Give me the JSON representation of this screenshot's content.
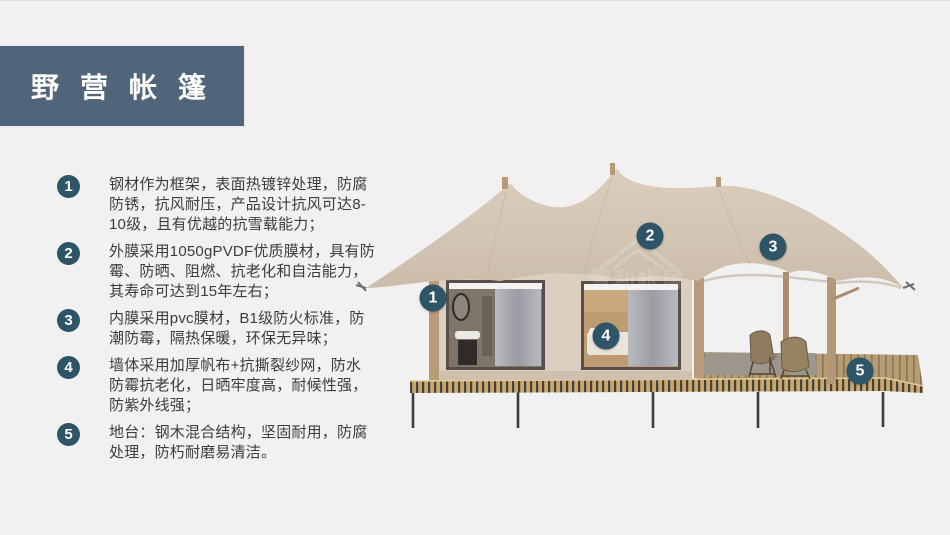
{
  "title": {
    "text": "野营帐篷"
  },
  "features": {
    "items": [
      {
        "number": "1",
        "text": "钢材作为框架，表面热镀锌处理，防腐防锈，抗风耐压，产品设计抗风可达8-10级，且有优越的抗雪载能力；"
      },
      {
        "number": "2",
        "text": "外膜采用1050gPVDF优质膜材，具有防霉、防晒、阻燃、抗老化和自洁能力，其寿命可达到15年左右；"
      },
      {
        "number": "3",
        "text": "内膜采用pvc膜材，B1级防火标准，防潮防霉，隔热保暖，环保无异味；"
      },
      {
        "number": "4",
        "text": "墙体采用加厚帆布+抗撕裂纱网，防水防霉抗老化，日晒牢度高，耐候性强，防紫外线强；"
      },
      {
        "number": "5",
        "text": "地台：钢木混合结构，坚固耐用，防腐处理，防朽耐磨易清洁。"
      }
    ]
  },
  "diagram": {
    "markers": [
      {
        "number": "1"
      },
      {
        "number": "2"
      },
      {
        "number": "3"
      },
      {
        "number": "4"
      },
      {
        "number": "5"
      }
    ],
    "watermark": "雪利帐居"
  },
  "colors": {
    "title_bg": "#4f6579",
    "badge": "#2e5467",
    "roof": "#d5c7b6",
    "wall": "#dccfc1",
    "deck_wood": "#c9a76b",
    "background": "#f1f1f2"
  }
}
